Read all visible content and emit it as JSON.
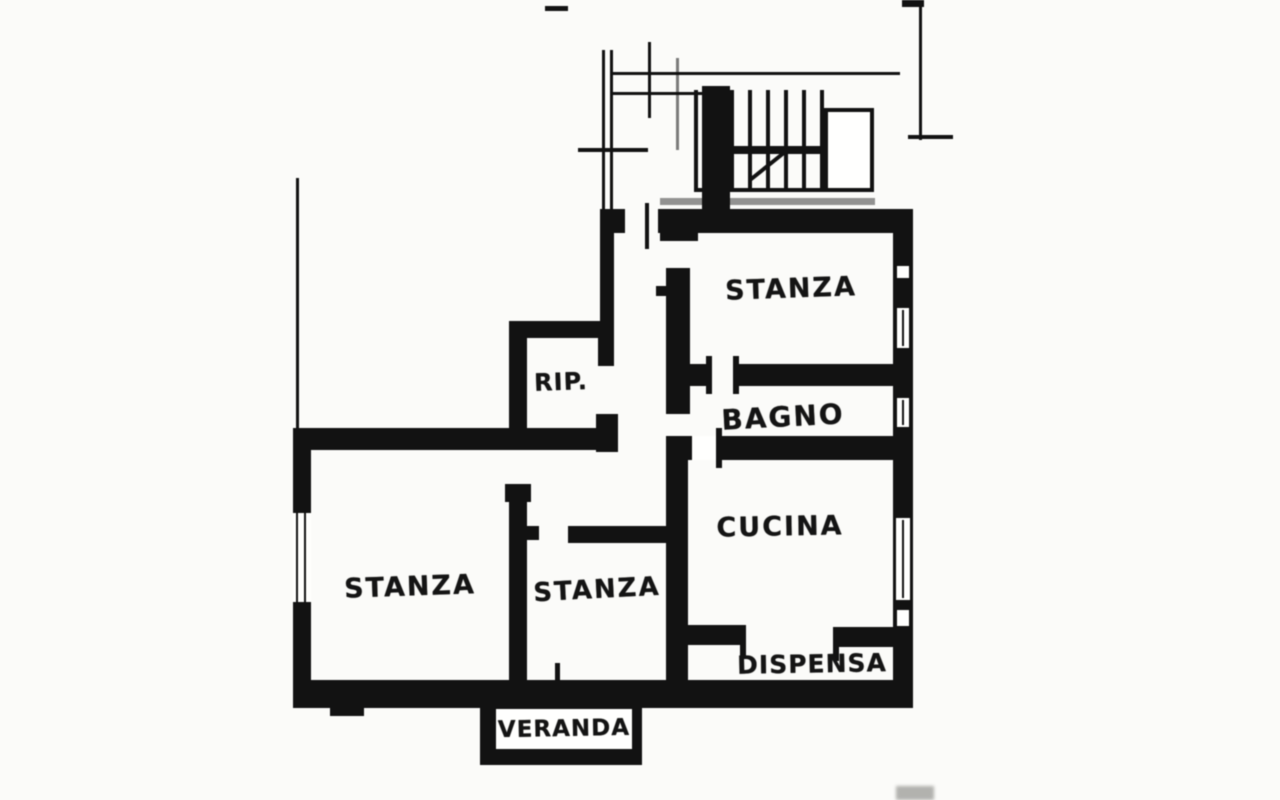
{
  "plan": {
    "kind": "apartment-floor-plan-scan",
    "colors": {
      "ink": "#161616",
      "paper": "#fbfbf9"
    },
    "rooms": [
      {
        "id": "stanza-top-right",
        "label": "STANZA"
      },
      {
        "id": "bagno",
        "label": "BAGNO"
      },
      {
        "id": "cucina",
        "label": "CUCINA"
      },
      {
        "id": "ripostiglio",
        "label": "RIP."
      },
      {
        "id": "stanza-left",
        "label": "STANZA"
      },
      {
        "id": "stanza-middle",
        "label": "STANZA"
      },
      {
        "id": "dispensa",
        "label": "DISPENSA"
      },
      {
        "id": "veranda",
        "label": "VERANDA"
      }
    ]
  }
}
